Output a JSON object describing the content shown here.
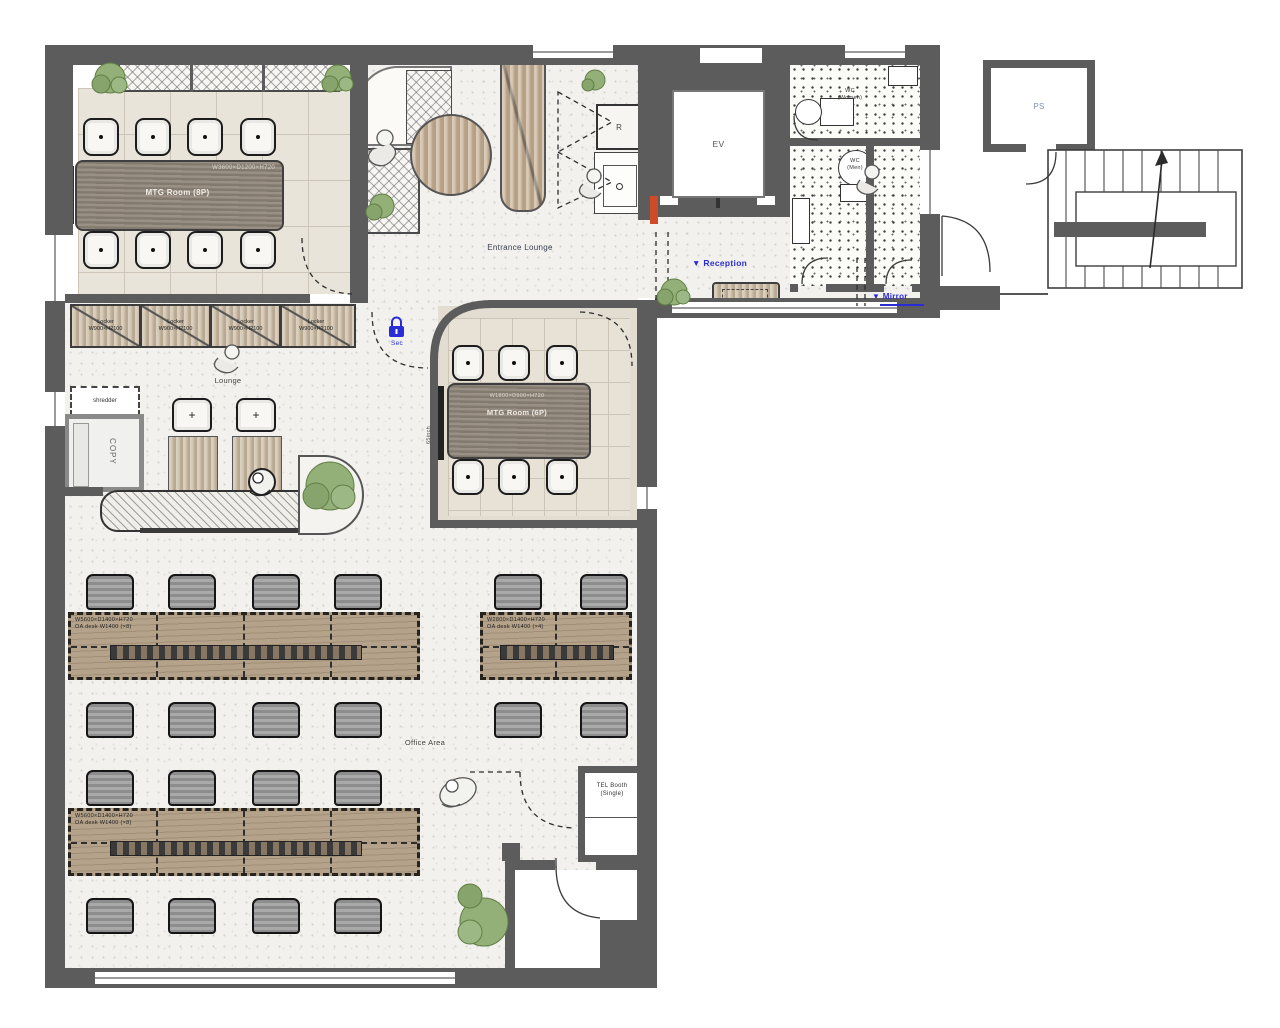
{
  "plan": {
    "rooms": {
      "mtg8": {
        "label": "MTG Room (8P)",
        "dim": "W3600×D1200×H720"
      },
      "mtg6": {
        "label": "MTG Room (6P)",
        "dim": "W1800×D900×H720",
        "tv": "65inch"
      },
      "entrance_lounge": {
        "label": "Entrance Lounge"
      },
      "lounge": {
        "label": "Lounge"
      },
      "office_area": {
        "label": "Office Area"
      },
      "tel_booth": {
        "label": "TEL Booth",
        "sub": "(Single)"
      },
      "elevator": {
        "label": "EV"
      },
      "pipe_shaft": {
        "label": "PS"
      },
      "wc_women": {
        "label": "WC",
        "sub": "(Women)"
      },
      "wc_men": {
        "label": "WC",
        "sub": "(Men)"
      },
      "fridge": {
        "label": "R"
      }
    },
    "annotations": {
      "reception": {
        "marker": "▼",
        "label": "Reception"
      },
      "mirror": {
        "marker": "▼",
        "label": "Mirror"
      },
      "security": {
        "label": "Sec"
      }
    },
    "equipment": {
      "copy": {
        "label": "COPY"
      },
      "shredder": {
        "label": "shredder"
      },
      "locker": {
        "line1": "Locker",
        "line2": "W900×H2100"
      },
      "desk_left": {
        "line1": "W5600×D1400×H720",
        "line2": "OA desk W1400 (×8)"
      },
      "desk_right": {
        "line1": "W2800×D1400×H720",
        "line2": "OA desk W1400 (×4)"
      }
    },
    "colors": {
      "wall": "#5d5c5c",
      "annotation_blue": "#2a2cd6",
      "accent_orange": "#cf4b28",
      "wood": "#b5a28a",
      "plant_green": "#93b078"
    }
  }
}
